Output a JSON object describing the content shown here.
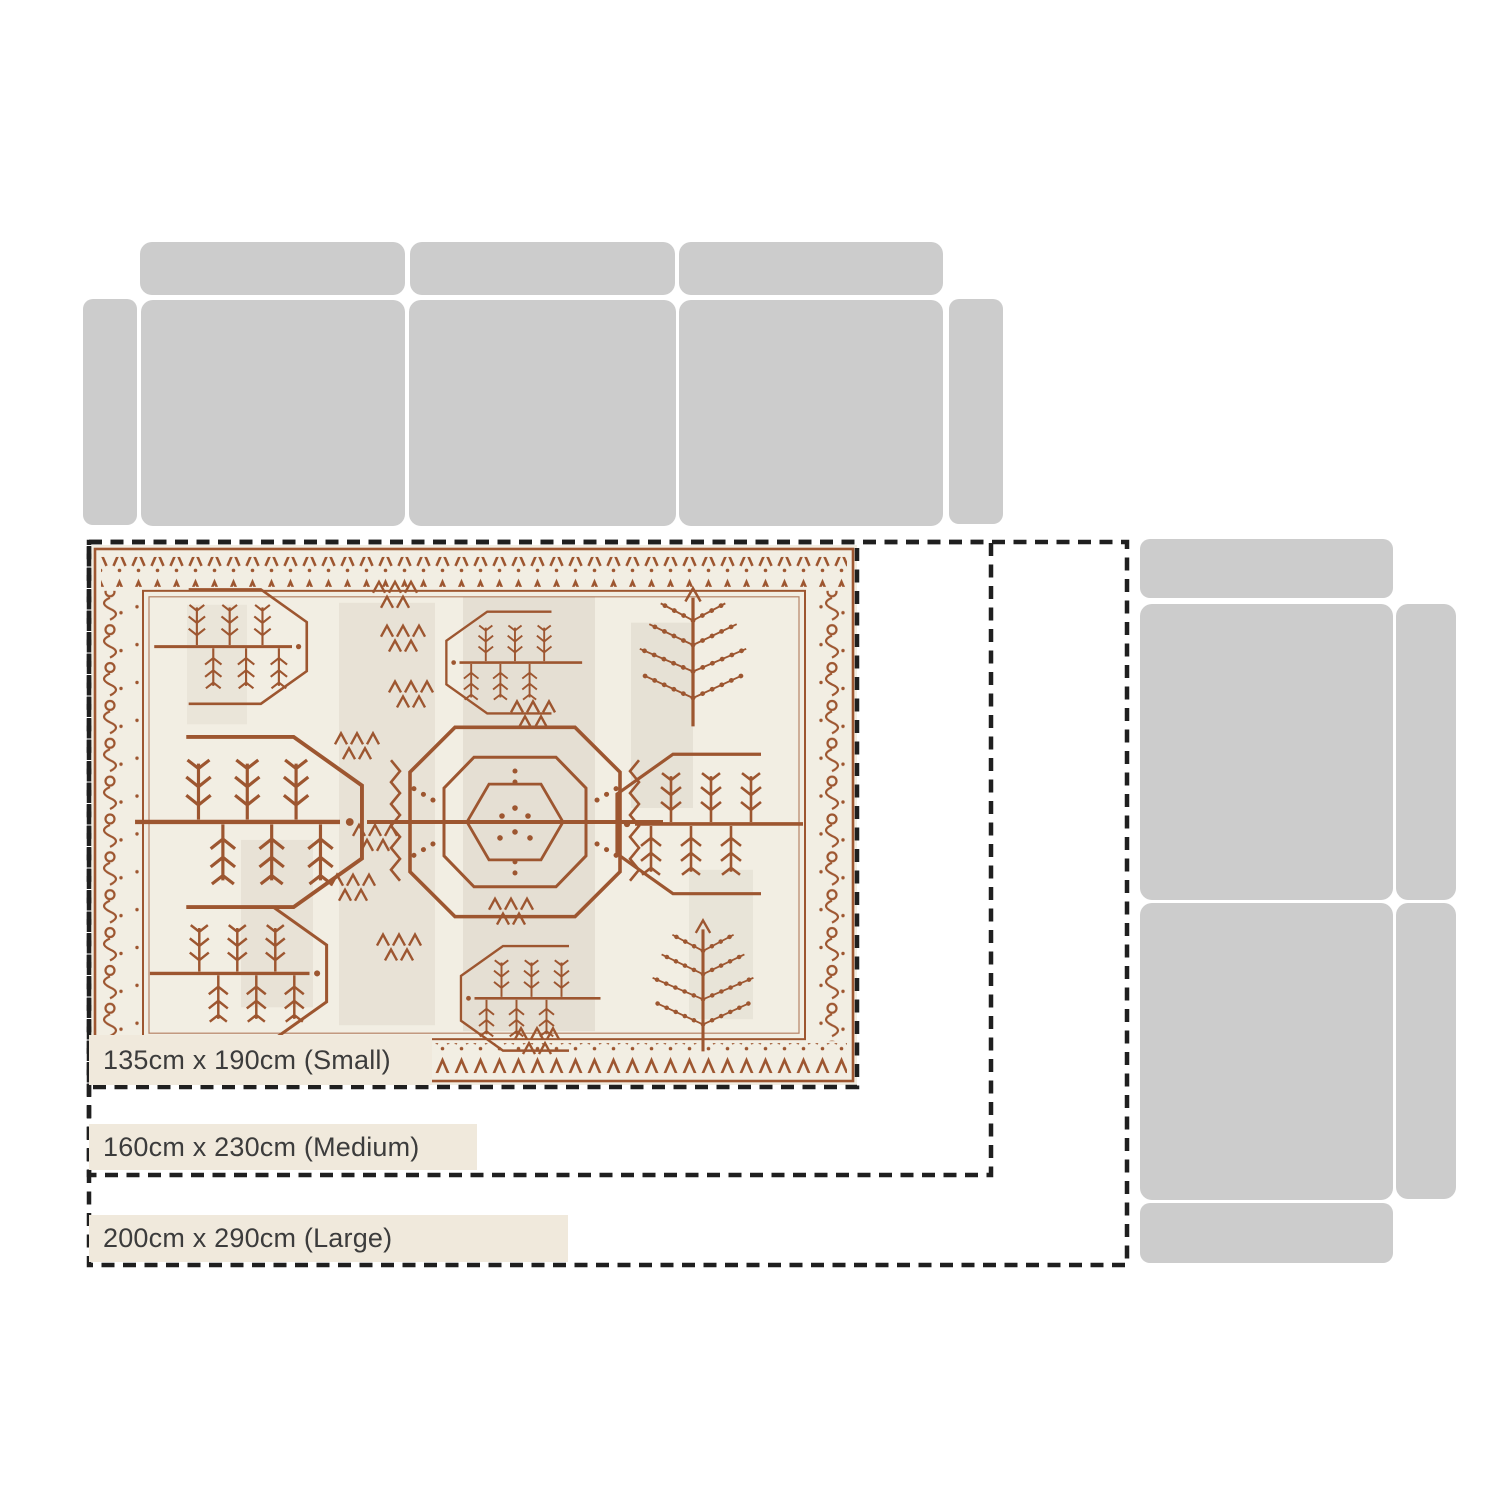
{
  "diagram": {
    "type": "rug-size-comparison-guide",
    "background_color": "#ffffff",
    "furniture_color": "#cccccc",
    "outline_color": "#1f1f1f",
    "label_background_color": "#f0e9dc",
    "label_text_color": "#3c3c3c",
    "rug": {
      "style": "oriental tribal tree-and-medallion pattern",
      "field_color": "#f2eee3",
      "pattern_color": "#9d5630",
      "shade_color": "#b3a796"
    },
    "sizes": [
      {
        "id": "small",
        "label": "135cm x 190cm (Small)"
      },
      {
        "id": "medium",
        "label": "160cm x 230cm (Medium)"
      },
      {
        "id": "large",
        "label": "200cm x 290cm (Large)"
      }
    ]
  }
}
